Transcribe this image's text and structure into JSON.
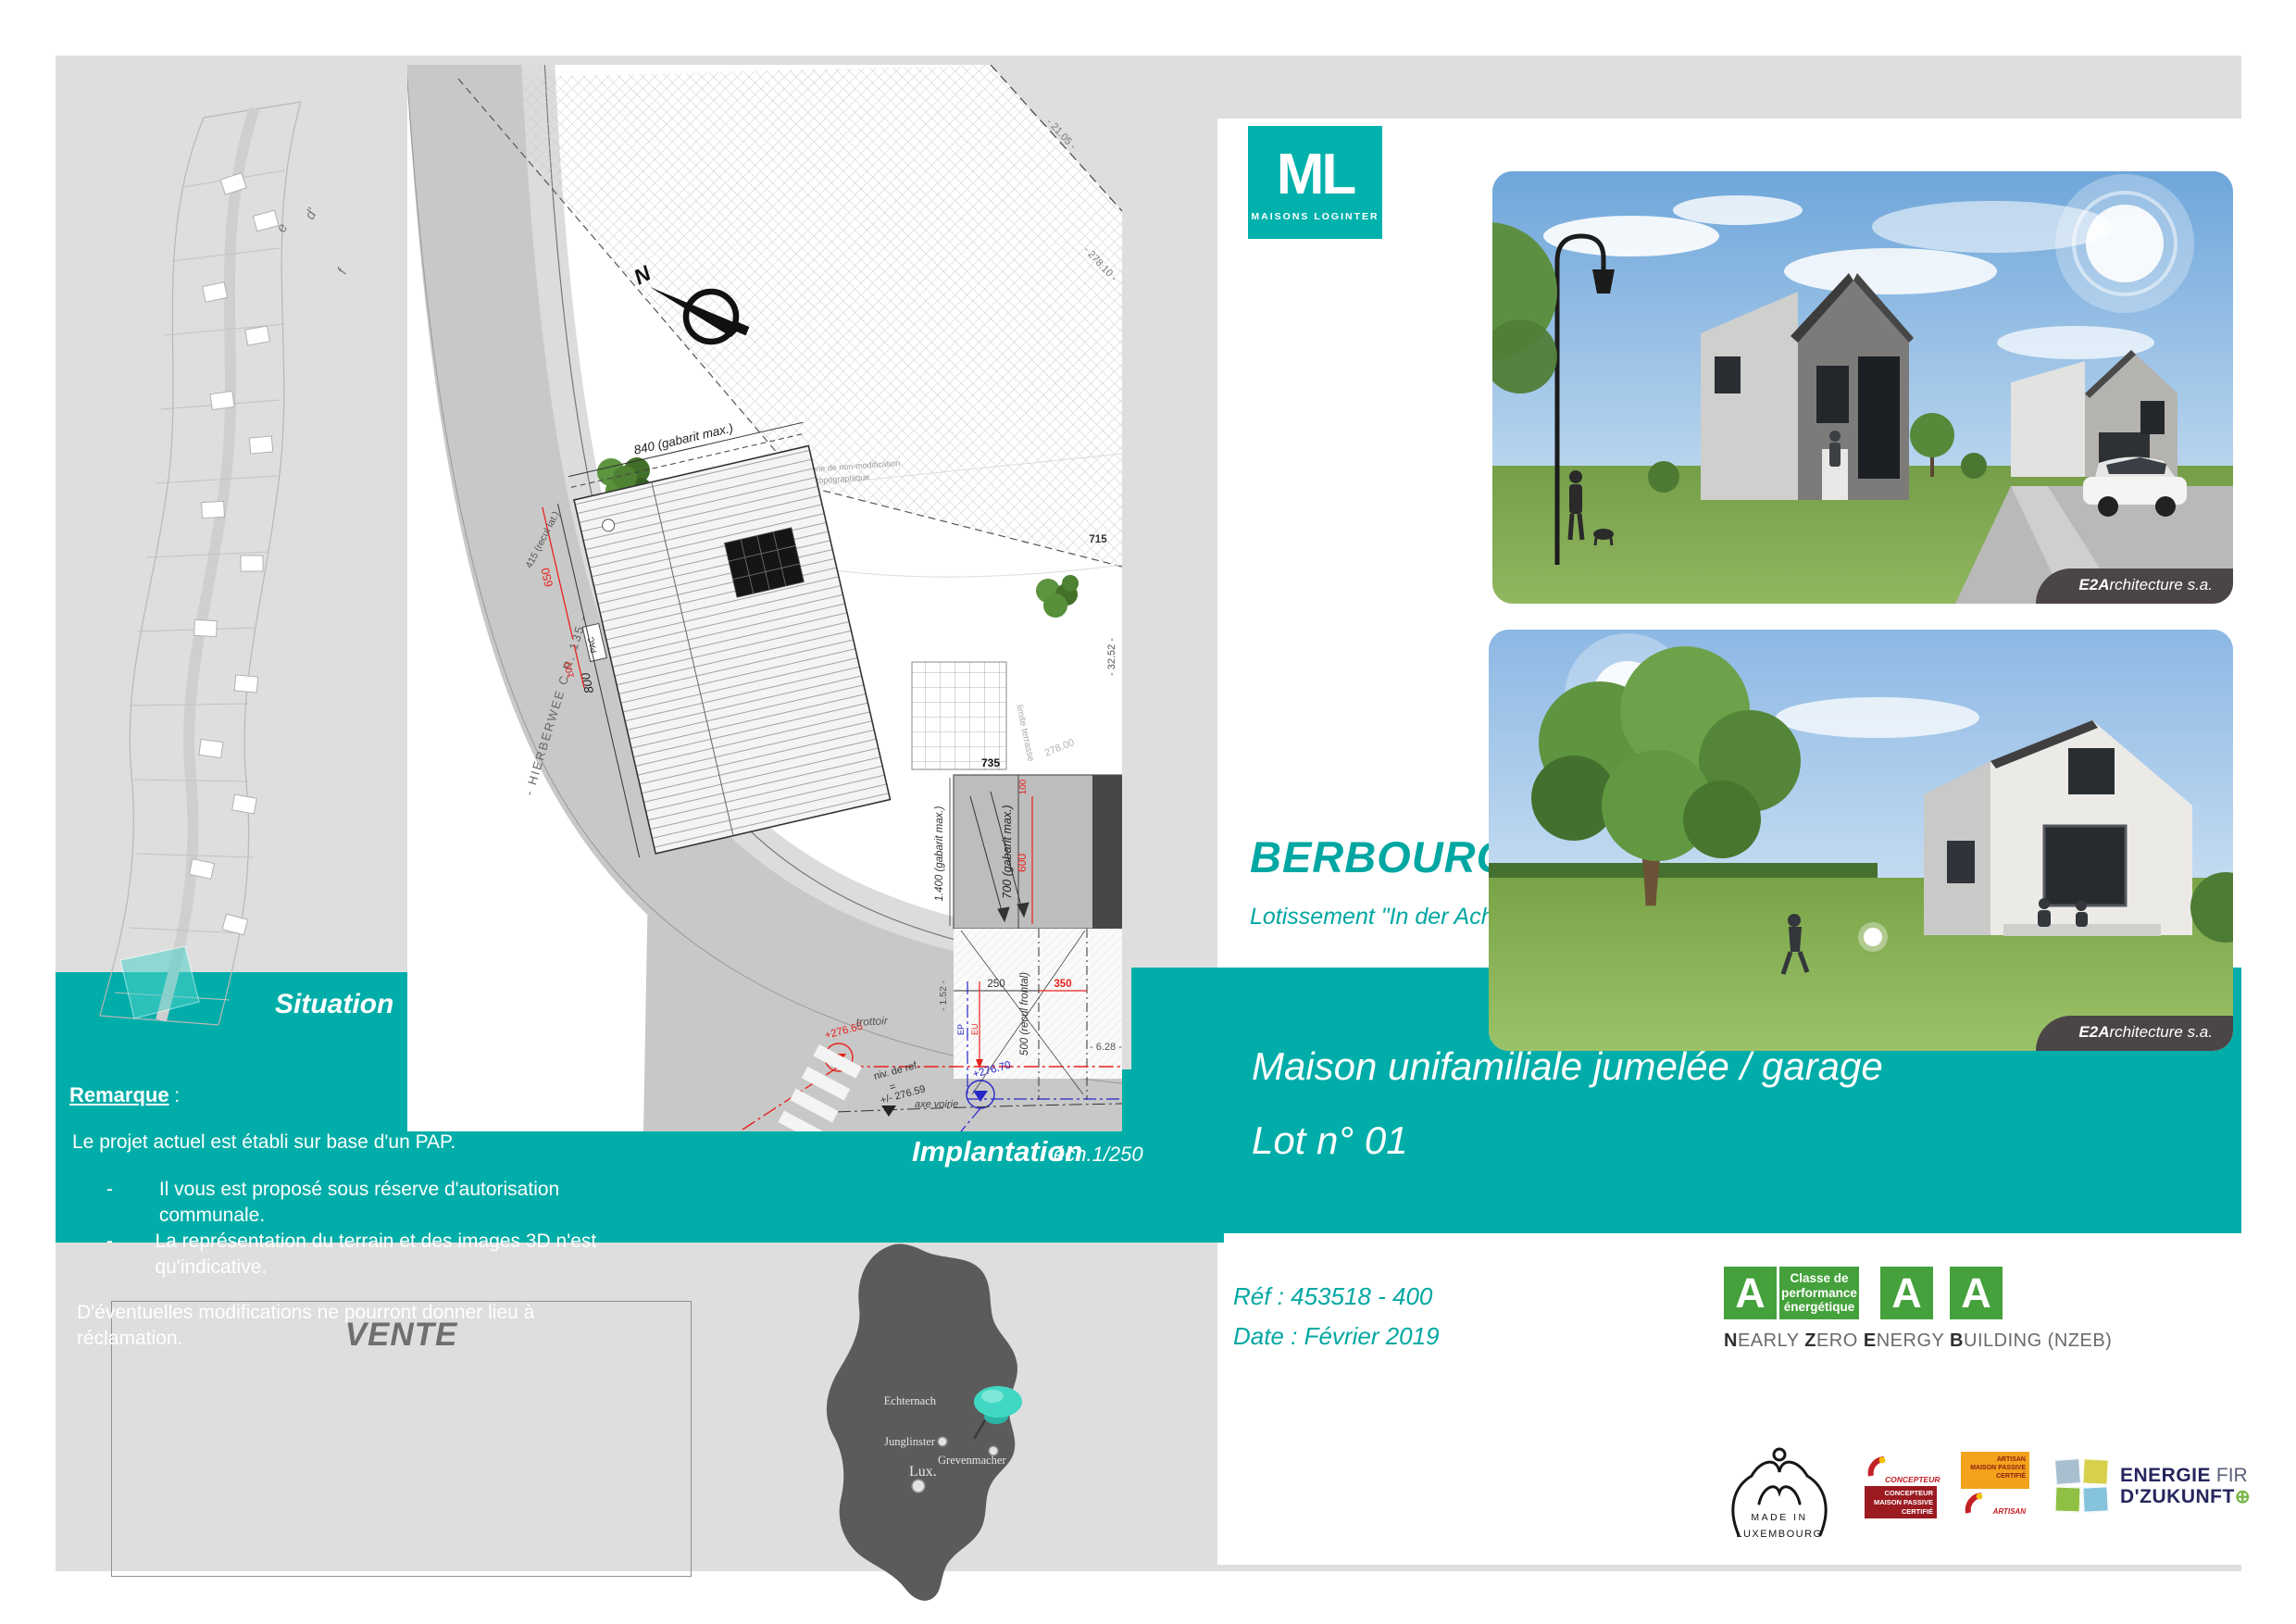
{
  "brand": {
    "letters": "ML",
    "name": "MAISONS LOGINTER"
  },
  "header": {
    "city": "BERBOURG",
    "subdivision": "Lotissement \"In der Acht\""
  },
  "banner": {
    "line1": "Maison unifamiliale jumelée / garage",
    "line2": "Lot n° 01"
  },
  "meta": {
    "ref": "Réf : 453518 - 400",
    "date": "Date : Février 2019"
  },
  "credit": {
    "bold": "E2A",
    "rest": "rchitecture s.a."
  },
  "sections": {
    "situation": "Situation",
    "implantation": "Implantation",
    "scale": "éch.1/250"
  },
  "remark": {
    "title": "Remarque",
    "colon": " :",
    "intro": "Le projet actuel est établi sur base d'un PAP.",
    "dash": "-",
    "bullet1": "Il vous est proposé sous réserve d'autorisation communale.",
    "bullet2": "La représentation du terrain et des images  3D n'est qu'indicative.",
    "outro": "D'éventuelles modifications ne pourront donner lieu à réclamation."
  },
  "sale": {
    "label": "VENTE"
  },
  "map": {
    "cities": [
      {
        "name": "Echternach"
      },
      {
        "name": "Junglinster"
      },
      {
        "name": "Grevenmacher"
      },
      {
        "name": "Lux."
      }
    ]
  },
  "energy": {
    "a": "A",
    "class_l1": "Classe de",
    "class_l2": "performance",
    "class_l3": "énergétique",
    "nzeb": [
      {
        "b": "N",
        "r": "EARLY "
      },
      {
        "b": "Z",
        "r": "ERO "
      },
      {
        "b": "E",
        "r": "NERGY "
      },
      {
        "b": "B",
        "r": "UILDING (NZEB)"
      }
    ]
  },
  "logos": {
    "made1": "MADE IN",
    "made2": "LUXEMBOURG",
    "concepteur_top": "CONCEPTEUR",
    "concepteur_l1": "CONCEPTEUR",
    "concepteur_l2": "MAISON PASSIVE",
    "concepteur_l3": "CERTIFIÉ",
    "artisan_l1": "ARTISAN",
    "artisan_l2": "MAISON PASSIVE",
    "artisan_l3": "CERTIFIÉ",
    "artisan_bottom": "ARTISAN",
    "energie_b1": "ENERGIE",
    "energie_r1": "FIR",
    "energie_b2": "D'ZUKUNFT",
    "energie_plus": "⊕"
  },
  "plan": {
    "north": "N",
    "lot": "LOT n° 01",
    "cad": "cad. 144/4097",
    "area": "08.08 ares",
    "zone1": "zone de non-modification",
    "zone2": "topographique",
    "road": "- HIERBERWEE   C.R. 135 -",
    "d840": "840 (gabarit max.)",
    "d800": "800",
    "d650": "650",
    "d100a": "100",
    "d1400": "1.400 (gabarit max.)",
    "d700": "700 (gabarit max.)",
    "d600": "600",
    "d100b": "100",
    "d735": "735",
    "d715": "715",
    "d278": "278.00",
    "d2105": "- 21.05 -",
    "d27810": "- 278.10 -",
    "d3252": "- 32.52 -",
    "d628": "- 6.28 -",
    "d152": "- 1.52 -",
    "d500": "500 (recul frontal)",
    "d350": "350",
    "d250": "250",
    "recul_lat": "415 (recul lat.)",
    "pac": "PAC",
    "limite": "limite terrasse",
    "trottoir": "trottoir",
    "axe": "axe voirie",
    "niv1": "niv. de ref.",
    "niv_eq": "=",
    "niv2": "+/- 276.59",
    "lvl_red": "+276.65",
    "lvl_blue": "+276.70",
    "ep": "EP",
    "eu": "EU"
  },
  "situation_plan": {
    "l1": "e",
    "l2": "d'",
    "l3": "f"
  }
}
